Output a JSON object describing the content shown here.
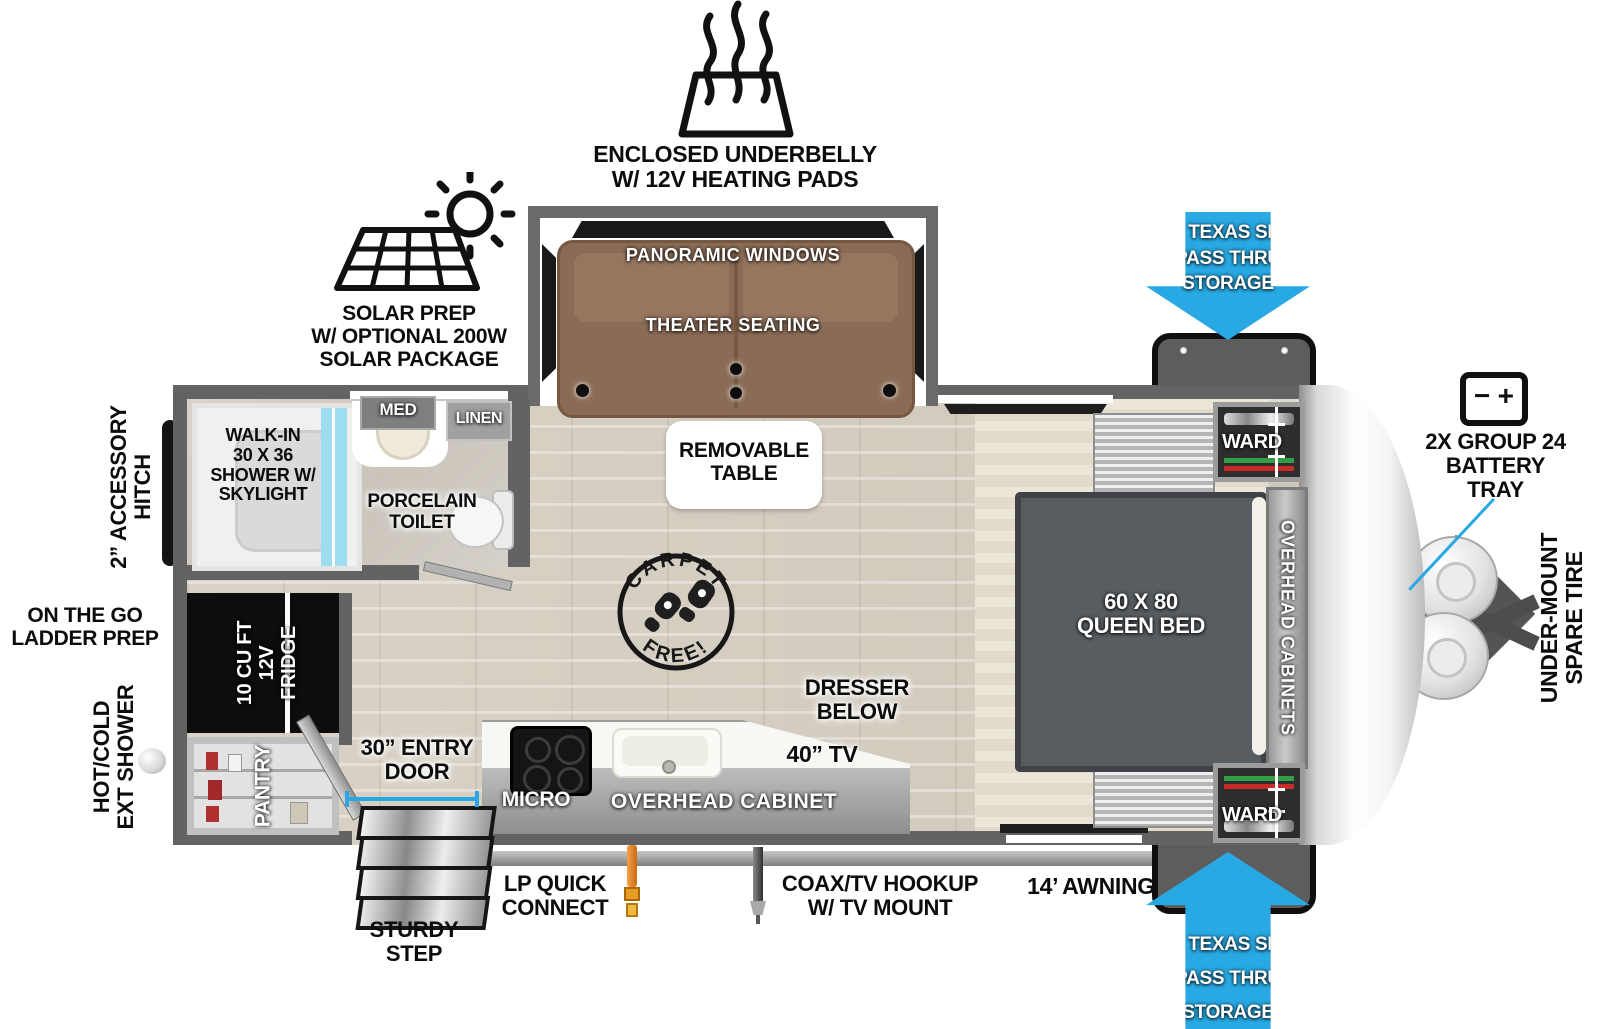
{
  "title": "Travel trailer floorplan diagram",
  "colors": {
    "arrow_blue": "#29a9e3",
    "wall_gray": "#636363",
    "sofa_brown": "#8e6f5a",
    "shower_glass": "#9edcef",
    "fridge_black": "#0d0d0d",
    "bed_gray": "#585d61"
  },
  "exterior_callouts": {
    "underbelly": {
      "label": "ENCLOSED UNDERBELLY\nW/ 12V HEATING PADS",
      "icon": "heating-pad-icon"
    },
    "solar": {
      "label": "SOLAR PREP\nW/ OPTIONAL 200W\nSOLAR PACKAGE",
      "icon": "solar-panel-icon"
    },
    "pass_thru_top": {
      "label": "XL TEXAS SIZE\nPASS THRU\nSTORAGE"
    },
    "pass_thru_bottom": {
      "label": "XL TEXAS SIZE\nPASS THRU\nSTORAGE"
    },
    "battery": {
      "label": "2X GROUP 24\nBATTERY\nTRAY",
      "icon": "battery-icon",
      "minus": "−",
      "plus": "+"
    },
    "spare_tire": {
      "label": "UNDER-MOUNT\nSPARE TIRE"
    },
    "accessory_hitch": {
      "label": "2” ACCESSORY\nHITCH"
    },
    "ladder_prep": {
      "label": "ON THE GO\nLADDER PREP"
    },
    "ext_shower": {
      "label": "HOT/COLD\nEXT SHOWER"
    },
    "entry_door": {
      "label": "30” ENTRY\nDOOR"
    },
    "sturdy_step": {
      "label": "STURDY\nSTEP"
    },
    "lp_connect": {
      "label": "LP QUICK\nCONNECT",
      "icon": "lp-connector-icon"
    },
    "coax": {
      "label": "COAX/TV HOOKUP\nW/ TV MOUNT",
      "icon": "coax-connector-icon"
    },
    "awning": {
      "label": "14’ AWNING"
    }
  },
  "interior_labels": {
    "panoramic_windows": "PANORAMIC WINDOWS",
    "theater_seating": "THEATER SEATING",
    "removable_table": "REMOVABLE\nTABLE",
    "queen_bed": "60 X 80\nQUEEN BED",
    "overhead_cabinets": "OVERHEAD CABINETS",
    "ward_top": "WARD",
    "ward_bottom": "WARD",
    "dresser": "DRESSER\nBELOW",
    "tv": "40” TV",
    "micro": "MICRO",
    "overhead_cabinet": "OVERHEAD CABINET",
    "shower": "WALK-IN\n30 X 36\nSHOWER W/\nSKYLIGHT",
    "med": "MED",
    "linen": "LINEN",
    "toilet": "PORCELAIN\nTOILET",
    "fridge": "10 CU FT\n12V\nFRIDGE",
    "pantry": "PANTRY",
    "carpet_stamp_top": "CARPET",
    "carpet_stamp_bottom": "FREE!"
  }
}
